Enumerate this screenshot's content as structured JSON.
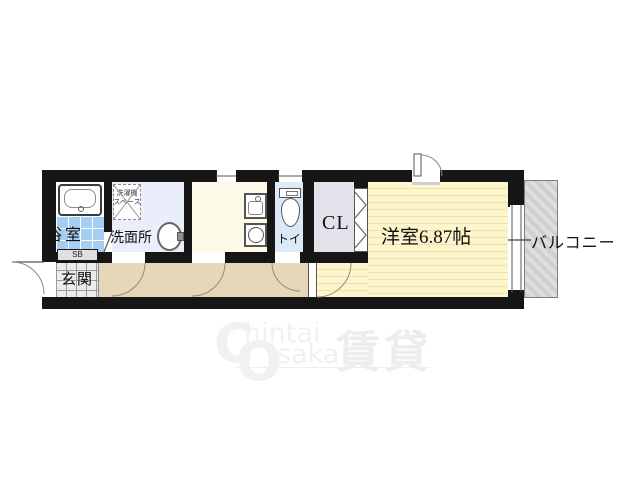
{
  "floorplan": {
    "labels": {
      "bathroom": "浴室",
      "washroom": "洗面所",
      "laundry_line1": "洗濯機",
      "laundry_line2": "スペース",
      "toilet": "トイレ",
      "closet": "CL",
      "western_room": "洋室6.87帖",
      "balcony": "バルコニー",
      "entrance": "玄関",
      "shoe_box": "SB"
    },
    "colors": {
      "wall": "#161616",
      "bathroom_tile": "#a6cdf2",
      "washroom_floor": "#e9eefa",
      "kitchen_floor": "#fdfae9",
      "toilet_floor": "#dce9f7",
      "closet_floor": "#e4e1eb",
      "western_room_floor": "#fcf5cd",
      "western_room_stripe": "#efe2a5",
      "corridor_floor": "#e6d7b8",
      "entrance_tile": "#ececec",
      "balcony_fill": "#d6d6d6"
    }
  },
  "watermark": {
    "initial_c": "C",
    "text_hintai": "hintai",
    "initial_o": "O",
    "text_saka": "saka",
    "kanji": "賃貸"
  }
}
